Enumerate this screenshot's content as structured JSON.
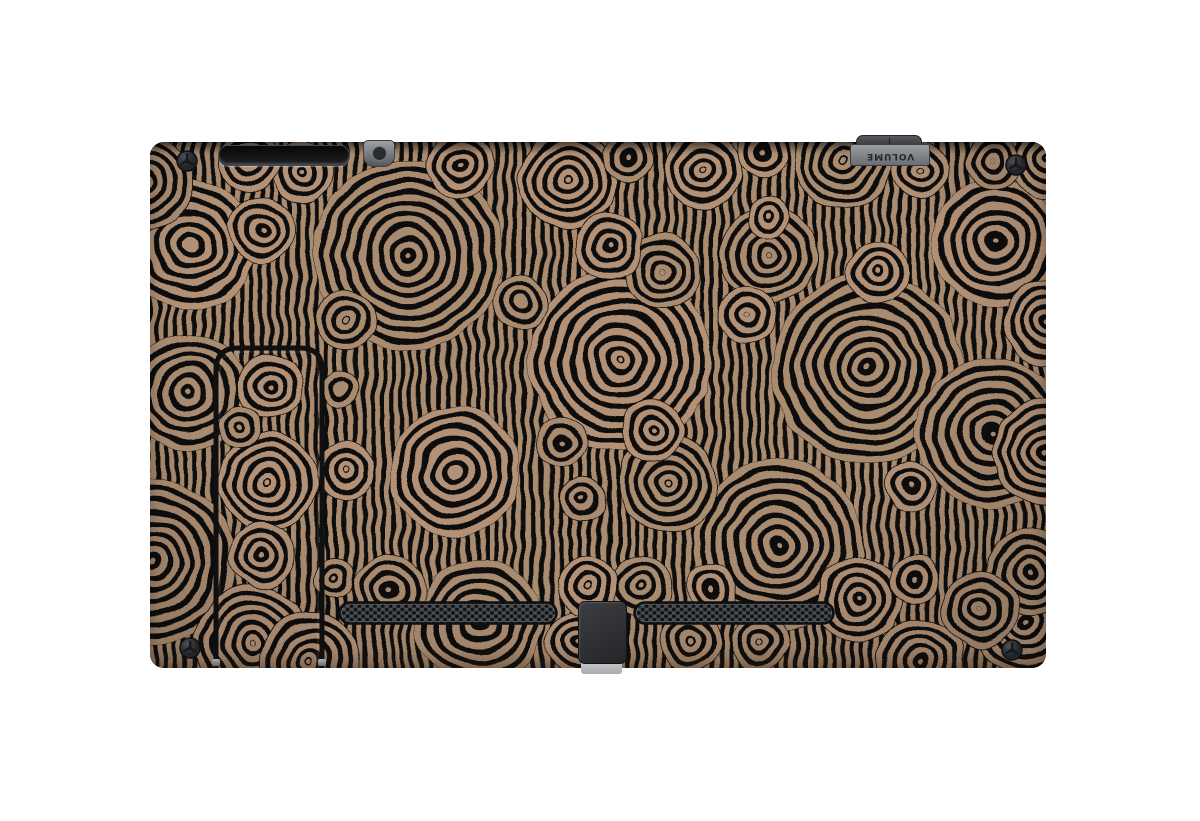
{
  "image": {
    "description": "Back view of a Nintendo Switch console wearing a circular aboriginal-style pattern skin",
    "background": "#ffffff"
  },
  "device": {
    "name": "Nintendo Switch console (back)",
    "volume_label": "VOLUME"
  },
  "colors": {
    "pattern_tan": "#a98b6f",
    "pattern_tan_alt": "#b29176",
    "pattern_black": "#0b0907",
    "chrome_dark": "#2f3134",
    "chrome_gray": "#85888c",
    "vent_gray": "#4a4d51",
    "vent_hole": "#101214",
    "port_light": "#c6c8ca",
    "screw_body": "#34363a"
  },
  "icons": {
    "screw": "tri-wing-screw-icon"
  }
}
